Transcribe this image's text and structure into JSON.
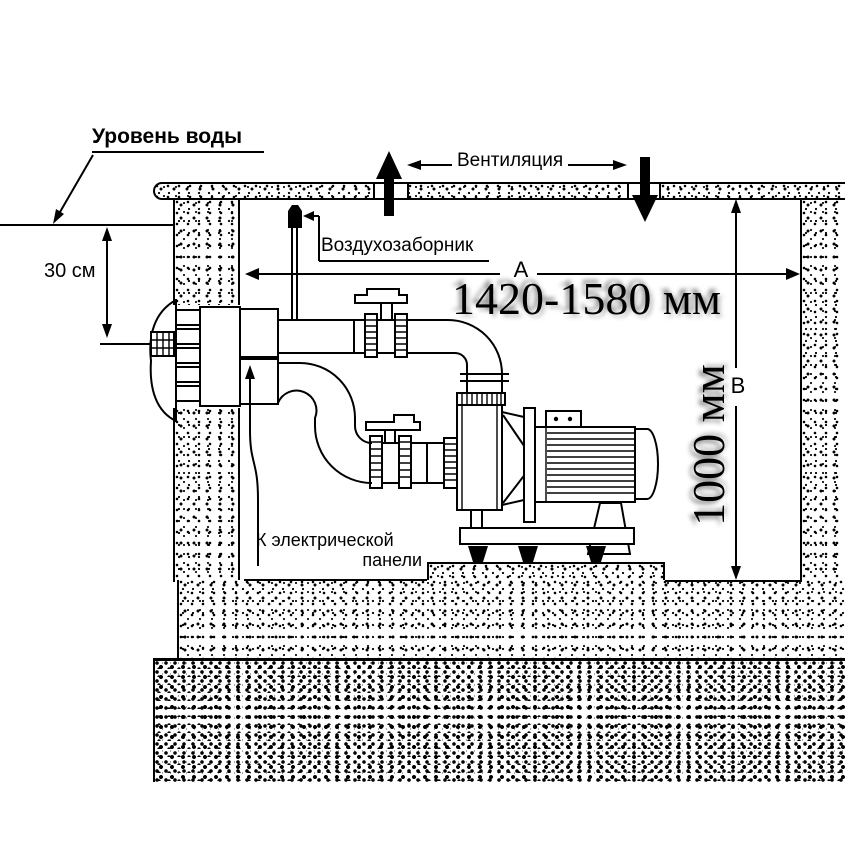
{
  "labels": {
    "water_level": "Уровень воды",
    "ventilation": "Вентиляция",
    "air_intake": "Воздухозаборник",
    "to_panel_line1": "К электрической",
    "to_panel_line2": "панели"
  },
  "dimensions": {
    "offset_depth": "30 см",
    "width_letter": "A",
    "width_value": "1420-1580 мм",
    "height_letter": "B",
    "height_value": "1000 мм"
  },
  "colors": {
    "line": "#000000",
    "background": "#ffffff"
  }
}
